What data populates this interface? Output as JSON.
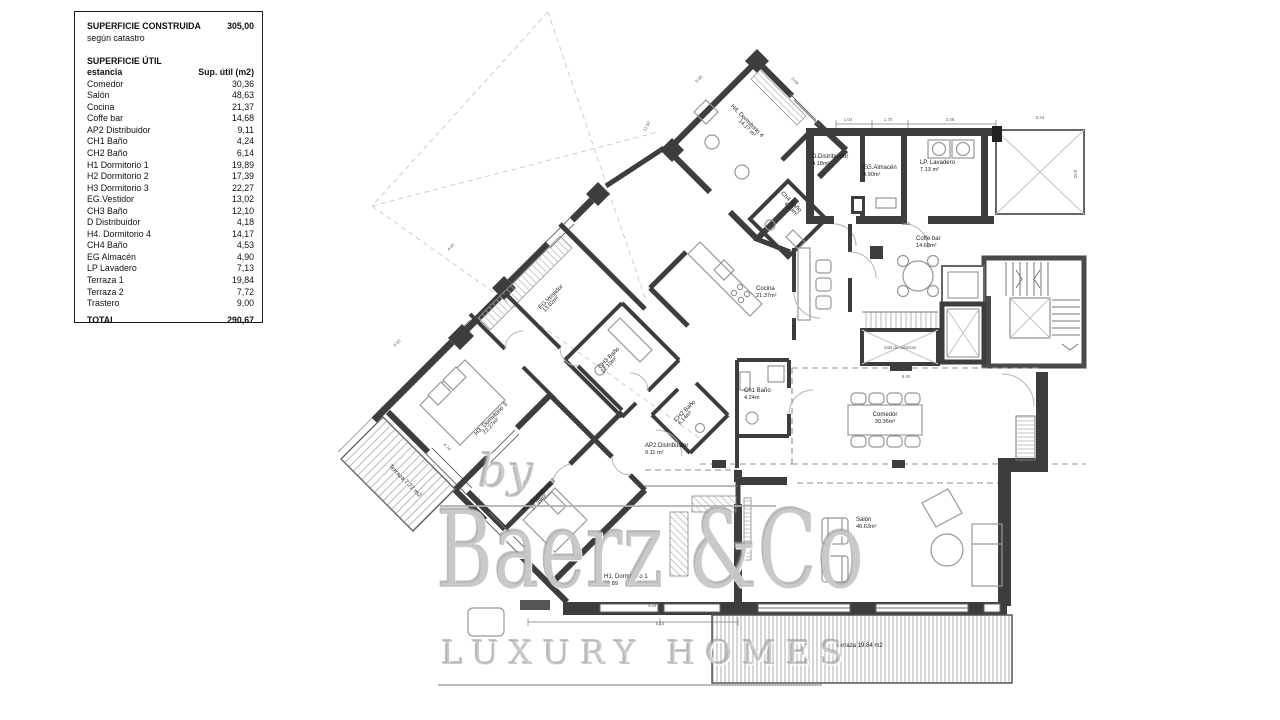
{
  "legend": {
    "title": "SUPERFICIE CONSTRUIDA",
    "title_value": "305,00",
    "subtitle": "según catastro",
    "section": "SUPERFICIE ÚTIL",
    "col_room": "estancia",
    "col_area": "Sup. útil (m2)",
    "rows": [
      [
        "Comedor",
        "30,36"
      ],
      [
        "Salón",
        "48,63"
      ],
      [
        "Cocina",
        "21,37"
      ],
      [
        "Coffe bar",
        "14,68"
      ],
      [
        "AP2 Distribuidor",
        "9,11"
      ],
      [
        "CH1 Baño",
        "4,24"
      ],
      [
        "CH2 Baño",
        "6,14"
      ],
      [
        "H1 Dormitorio 1",
        "19,89"
      ],
      [
        "H2 Dormitorio 2",
        "17,39"
      ],
      [
        "H3 Dormitorio 3",
        "22,27"
      ],
      [
        "EG.Vestidor",
        "13,02"
      ],
      [
        "CH3 Baño",
        "12,10"
      ],
      [
        "D Distribuidor",
        "4,18"
      ],
      [
        "H4. Dormitorio 4",
        "14,17"
      ],
      [
        "CH4 Baño",
        "4,53"
      ],
      [
        "EG Almacén",
        "4,90"
      ],
      [
        "LP Lavadero",
        "7,13"
      ],
      [
        "Terraza 1",
        "19,84"
      ],
      [
        "Terraza 2",
        "7,72"
      ],
      [
        "Trastero",
        "9,00"
      ]
    ],
    "total_label": "TOTAL",
    "total_value": "290,67"
  },
  "watermark": {
    "by": "by",
    "brand": "Baerz &Co",
    "tagline": "LUXURY HOMES"
  },
  "plan": {
    "room_labels": [
      {
        "id": "h4-dormitorio-4",
        "name": "H4. Dormitorio 4",
        "area": "14.17 m²",
        "x": 746,
        "y": 122,
        "rot": 45,
        "anchor": "middle"
      },
      {
        "id": "ch4-bano",
        "name": "Ch4 Baño",
        "area": "4.53m²",
        "x": 790,
        "y": 203,
        "rot": 45,
        "anchor": "middle"
      },
      {
        "id": "d-distribuidor",
        "name": "D.Distribuidor",
        "area": "4.18m²",
        "x": 812,
        "y": 158,
        "rot": 0,
        "anchor": "start"
      },
      {
        "id": "eg-almacen",
        "name": "EG.Almacén",
        "area": "4.90m²",
        "x": 863,
        "y": 169,
        "rot": 0,
        "anchor": "start"
      },
      {
        "id": "lp-lavadero",
        "name": "LP. Lavadero",
        "area": "7.13 m²",
        "x": 920,
        "y": 164,
        "rot": 0,
        "anchor": "start"
      },
      {
        "id": "coffe-bar",
        "name": "Coffe bar",
        "area": "14.68m²",
        "x": 916,
        "y": 240,
        "rot": 0,
        "anchor": "start"
      },
      {
        "id": "cocina",
        "name": "Cocina",
        "area": "21.37m²",
        "x": 756,
        "y": 290,
        "rot": 0,
        "anchor": "start"
      },
      {
        "id": "eg-vestidor",
        "name": "EG.Vestidor",
        "area": "13.02m²",
        "x": 552,
        "y": 298,
        "rot": -45,
        "anchor": "middle"
      },
      {
        "id": "ch3-bano",
        "name": "CH3 Baño",
        "area": "12.10m²",
        "x": 610,
        "y": 359,
        "rot": -45,
        "anchor": "middle"
      },
      {
        "id": "ch2-bano",
        "name": "CH2 Baño",
        "area": "6.14m²",
        "x": 686,
        "y": 412,
        "rot": -45,
        "anchor": "middle"
      },
      {
        "id": "ch1-bano",
        "name": "Ch1 Baño",
        "area": "4.24m",
        "x": 744,
        "y": 392,
        "rot": 0,
        "anchor": "start"
      },
      {
        "id": "ap2-distribuidor",
        "name": "AP2.Distribuidor",
        "area": "9.11 m²",
        "x": 645,
        "y": 447,
        "rot": 0,
        "anchor": "start"
      },
      {
        "id": "h3-dormitorio-3",
        "name": "H3. Dormitorio 3",
        "area": "22.27m²",
        "x": 492,
        "y": 420,
        "rot": -45,
        "anchor": "middle"
      },
      {
        "id": "h2-dormitorio-2",
        "name": "H2. Dormitorio 2",
        "area": "17.39m²",
        "x": 540,
        "y": 496,
        "rot": -45,
        "anchor": "middle"
      },
      {
        "id": "h1-dormitorio-1",
        "name": "H1. Dormitorio 1",
        "area": "19.89",
        "x": 604,
        "y": 578,
        "rot": 0,
        "anchor": "start"
      },
      {
        "id": "terraza-2",
        "name": "Terraza 7.72 m2",
        "area": "",
        "x": 404,
        "y": 482,
        "rot": 45,
        "anchor": "middle"
      },
      {
        "id": "terraza-1",
        "name": "Terraza 19.84 m2",
        "area": "",
        "x": 836,
        "y": 647,
        "rot": 0,
        "anchor": "start"
      },
      {
        "id": "comedor",
        "name": "Comedor",
        "area": "30.36m²",
        "x": 885,
        "y": 416,
        "rot": 0,
        "anchor": "middle"
      },
      {
        "id": "salon",
        "name": "Salón",
        "area": "46.63m²",
        "x": 856,
        "y": 521,
        "rot": 0,
        "anchor": "start"
      }
    ],
    "dim_labels": [
      {
        "text": "12.50",
        "x": 648,
        "y": 127,
        "rot": -63
      },
      {
        "text": "5.95",
        "x": 700,
        "y": 80,
        "rot": -45
      },
      {
        "text": "3.04",
        "x": 794,
        "y": 82,
        "rot": 45
      },
      {
        "text": "1.04",
        "x": 848,
        "y": 121,
        "rot": 0
      },
      {
        "text": "1.70",
        "x": 888,
        "y": 121,
        "rot": 0
      },
      {
        "text": "2.48",
        "x": 950,
        "y": 121,
        "rot": 0
      },
      {
        "text": "3.34",
        "x": 1040,
        "y": 119,
        "rot": 0
      },
      {
        "text": "3.02",
        "x": 1074,
        "y": 174,
        "rot": 90
      },
      {
        "text": "5.26",
        "x": 906,
        "y": 225,
        "rot": 0
      },
      {
        "text": "8.40",
        "x": 906,
        "y": 378,
        "rot": 0
      },
      {
        "text": "4.40",
        "x": 452,
        "y": 248,
        "rot": -45
      },
      {
        "text": "6.50",
        "x": 398,
        "y": 344,
        "rot": -45
      },
      {
        "text": "4.74",
        "x": 446,
        "y": 448,
        "rot": 45
      },
      {
        "text": "4.54",
        "x": 652,
        "y": 607,
        "rot": 0
      },
      {
        "text": "5.14",
        "x": 660,
        "y": 625,
        "rot": 0
      },
      {
        "text": "sala de calderas",
        "x": 900,
        "y": 349,
        "rot": 0
      }
    ]
  },
  "colors": {
    "wall": "#3d3d3d",
    "line": "#777777",
    "furniture": "#979797",
    "hatch": "#9a9a9a",
    "dashed": "#8f8f8f",
    "label": "#1d1d1d",
    "dim": "#5f5f5f",
    "watermark": "#acacac"
  }
}
